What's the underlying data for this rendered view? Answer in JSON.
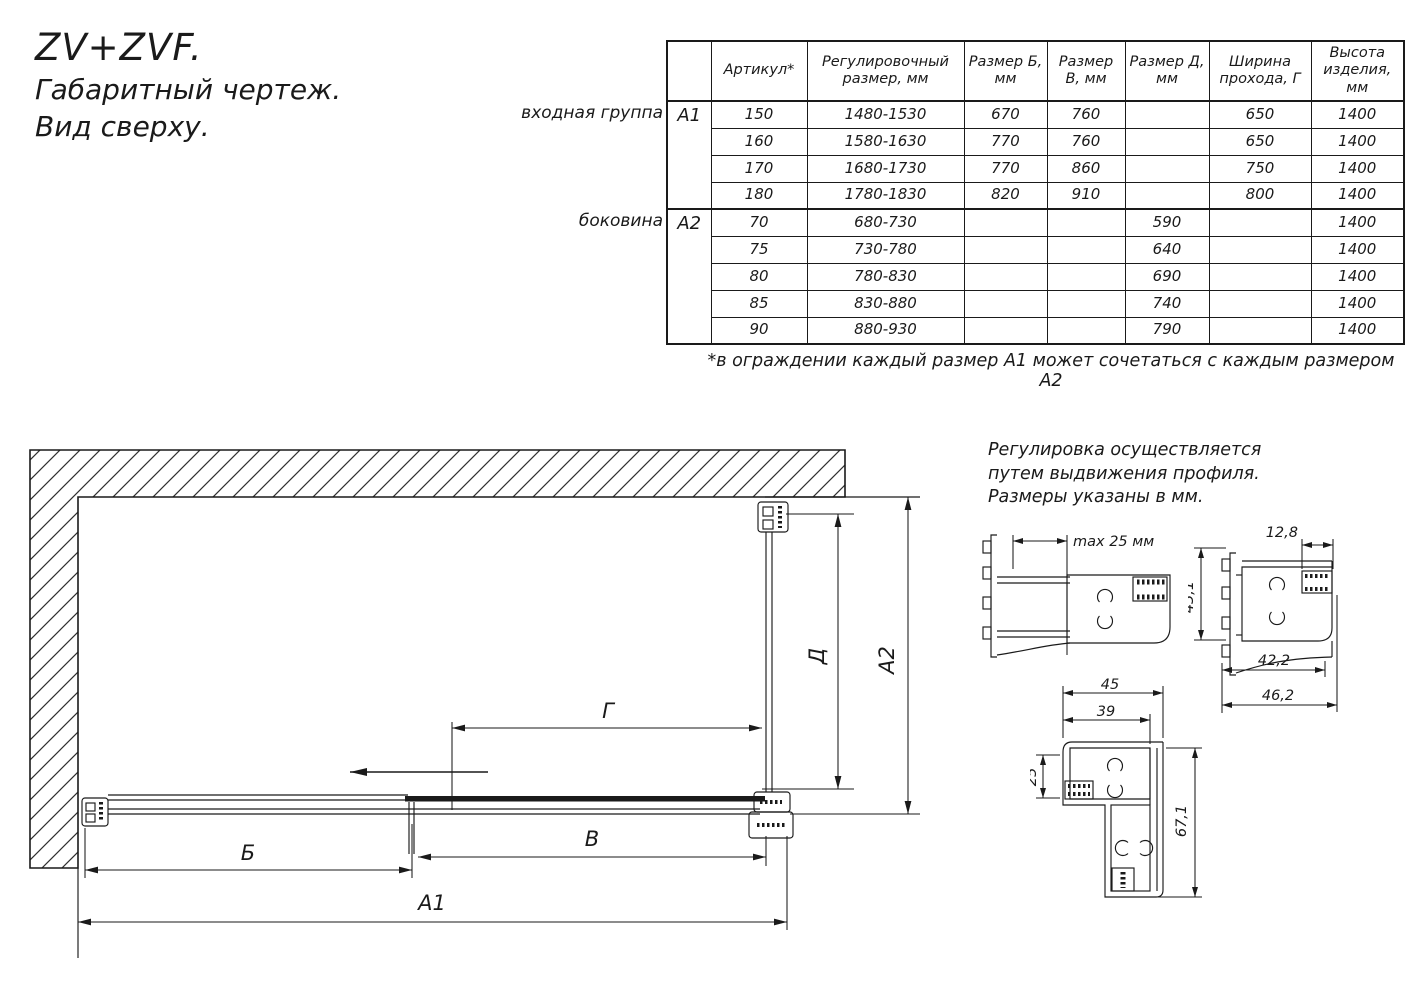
{
  "title": {
    "line1": "ZV+ZVF.",
    "line2": "Габаритный чертеж.",
    "line3": "Вид сверху."
  },
  "table": {
    "headers": [
      "Артикул*",
      "Регулировочный размер, мм",
      "Размер Б, мм",
      "Размер В, мм",
      "Размер Д, мм",
      "Ширина прохода, Г",
      "Высота изделия, мм"
    ],
    "groups": [
      {
        "label": "входная группа",
        "code": "А1",
        "rows": [
          [
            "150",
            "1480-1530",
            "670",
            "760",
            "",
            "650",
            "1400"
          ],
          [
            "160",
            "1580-1630",
            "770",
            "760",
            "",
            "650",
            "1400"
          ],
          [
            "170",
            "1680-1730",
            "770",
            "860",
            "",
            "750",
            "1400"
          ],
          [
            "180",
            "1780-1830",
            "820",
            "910",
            "",
            "800",
            "1400"
          ]
        ]
      },
      {
        "label": "боковина",
        "code": "А2",
        "rows": [
          [
            "70",
            "680-730",
            "",
            "",
            "590",
            "",
            "1400"
          ],
          [
            "75",
            "730-780",
            "",
            "",
            "640",
            "",
            "1400"
          ],
          [
            "80",
            "780-830",
            "",
            "",
            "690",
            "",
            "1400"
          ],
          [
            "85",
            "830-880",
            "",
            "",
            "740",
            "",
            "1400"
          ],
          [
            "90",
            "880-930",
            "",
            "",
            "790",
            "",
            "1400"
          ]
        ]
      }
    ],
    "footnote": "*в ограждении каждый размер А1 может сочетаться с каждым размером А2"
  },
  "note": {
    "line1": "Регулировка осуществляется",
    "line2": "путем выдвижения профиля.",
    "line3": "Размеры указаны в мм."
  },
  "drawing": {
    "dim_b": "Б",
    "dim_v": "В",
    "dim_a1": "А1",
    "dim_g": "Г",
    "dim_d": "Д",
    "dim_a2": "А2"
  },
  "profiles": {
    "p1": {
      "dim": "max 25 мм"
    },
    "p2": {
      "top": "12,8",
      "left": "43,1",
      "bottom_inner": "42,2",
      "bottom_outer": "46,2"
    },
    "p3": {
      "top_outer": "45",
      "top_inner": "39",
      "left": "25",
      "right": "67,1"
    }
  },
  "colors": {
    "line": "#1a1a1a",
    "background": "#ffffff"
  }
}
